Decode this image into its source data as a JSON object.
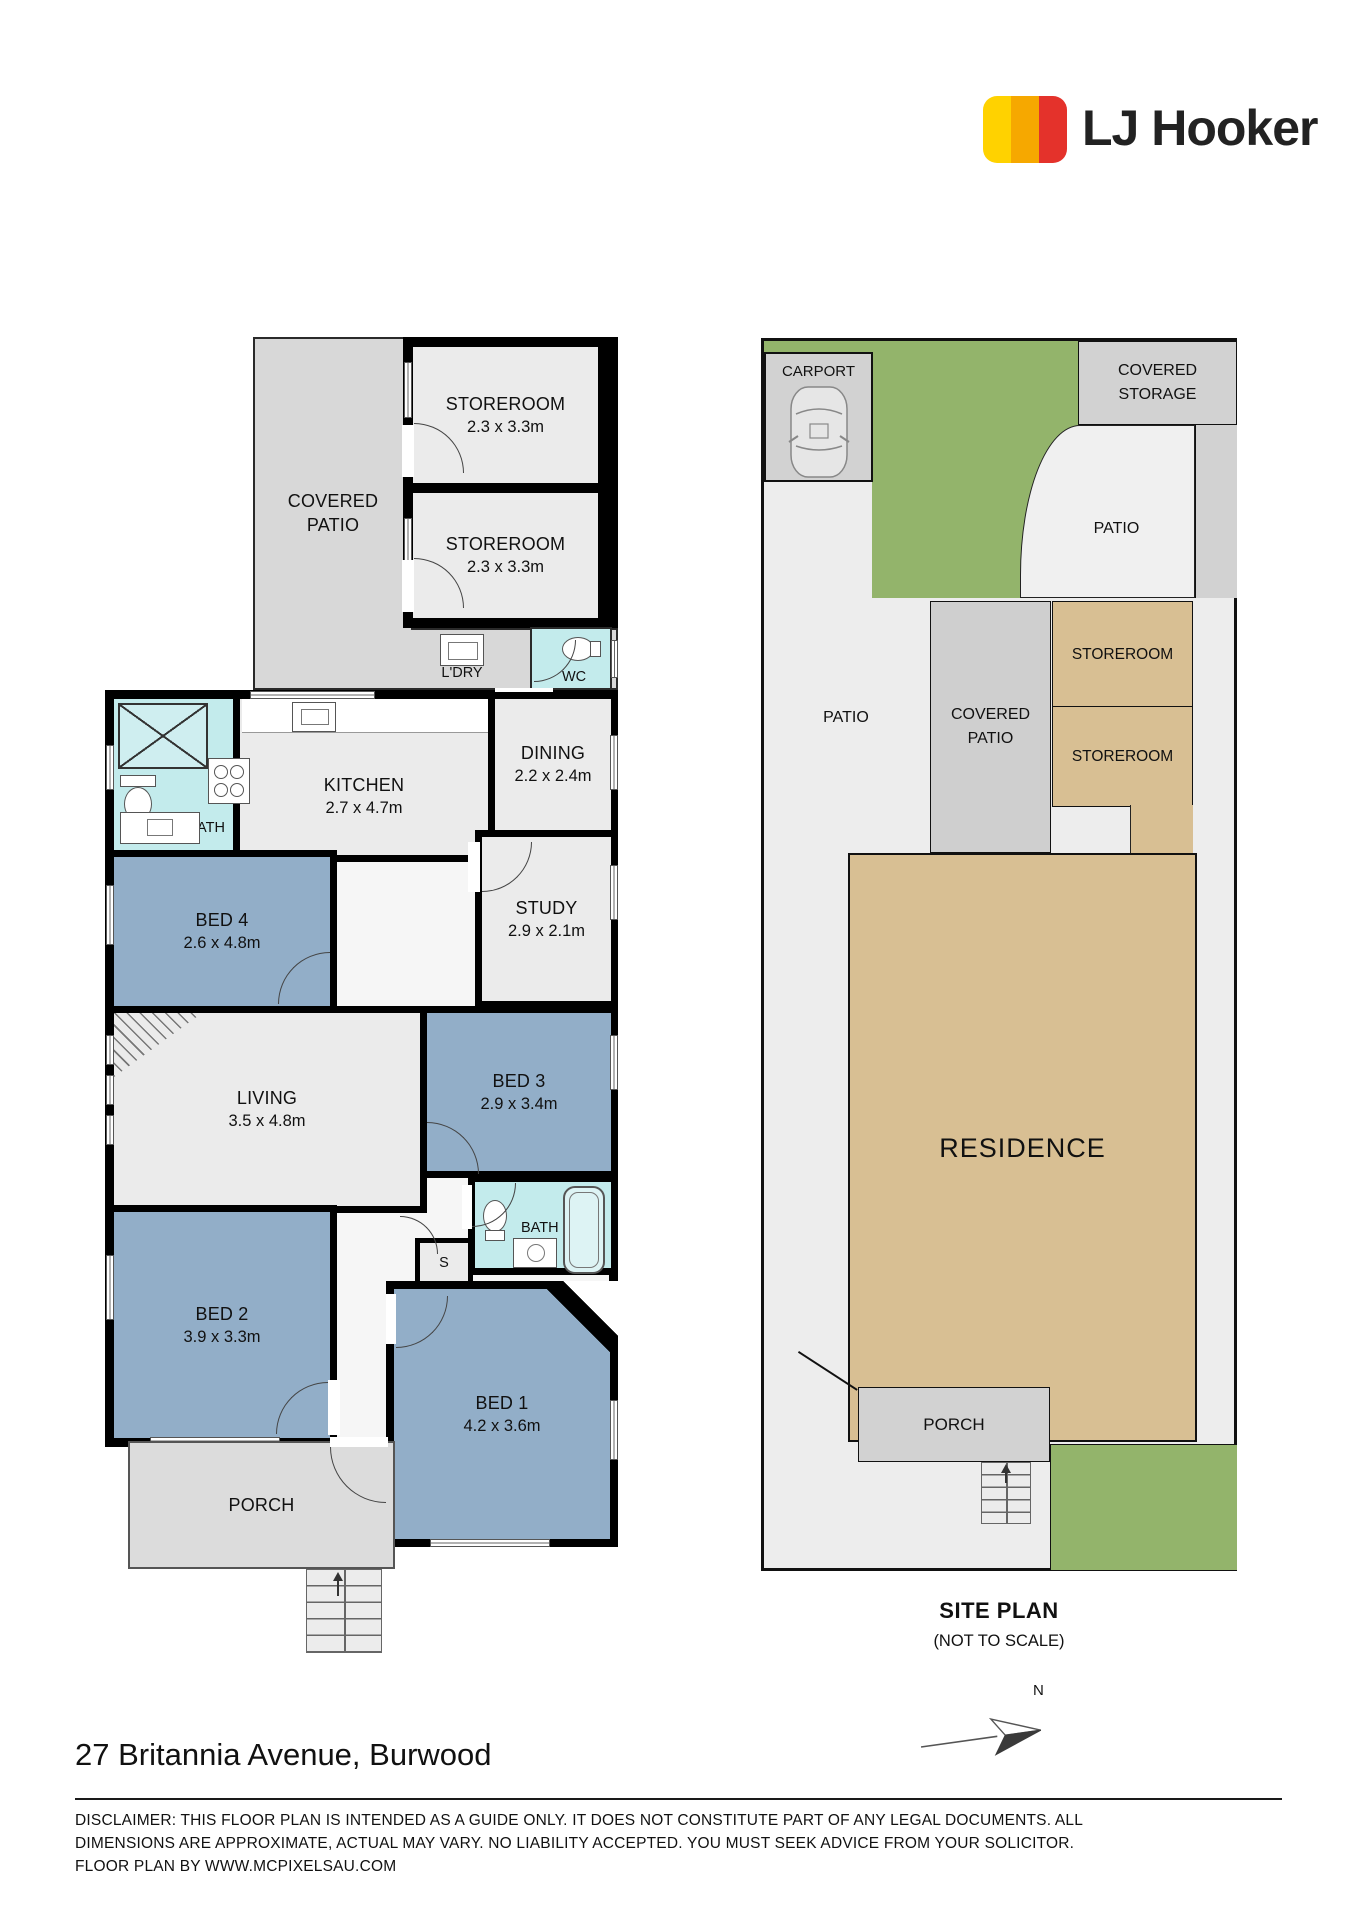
{
  "brand": {
    "name": "LJ Hooker"
  },
  "floor_plan": {
    "covered_patio": {
      "line1": "COVERED",
      "line2": "PATIO"
    },
    "storeroom_top1": {
      "name": "STOREROOM",
      "dims": "2.3 x 3.3m"
    },
    "storeroom_top2": {
      "name": "STOREROOM",
      "dims": "2.3 x 3.3m"
    },
    "laundry": {
      "name": "L'DRY"
    },
    "wc": {
      "name": "WC"
    },
    "kitchen": {
      "name": "KITCHEN",
      "dims": "2.7 x 4.7m"
    },
    "dining": {
      "name": "DINING",
      "dims": "2.2 x 2.4m"
    },
    "bath_top": {
      "name": "BATH"
    },
    "bed4": {
      "name": "BED 4",
      "dims": "2.6 x 4.8m"
    },
    "study": {
      "name": "STUDY",
      "dims": "2.9 x 2.1m"
    },
    "living": {
      "name": "LIVING",
      "dims": "3.5 x 4.8m"
    },
    "bed3": {
      "name": "BED 3",
      "dims": "2.9 x 3.4m"
    },
    "bath_bottom": {
      "name": "BATH"
    },
    "store_s": {
      "name": "S"
    },
    "bed2": {
      "name": "BED 2",
      "dims": "3.9 x 3.3m"
    },
    "bed1": {
      "name": "BED 1",
      "dims": "4.2 x 3.6m"
    },
    "porch": {
      "name": "PORCH"
    }
  },
  "site_plan": {
    "carport": "CARPORT",
    "covered_storage": {
      "line1": "COVERED",
      "line2": "STORAGE"
    },
    "patio_upper": "PATIO",
    "patio_left": "PATIO",
    "covered_patio": {
      "line1": "COVERED",
      "line2": "PATIO"
    },
    "storeroom1": "STOREROOM",
    "storeroom2": "STOREROOM",
    "residence": "RESIDENCE",
    "porch": "PORCH",
    "caption_title": "SITE PLAN",
    "caption_subtitle": "(NOT TO SCALE)"
  },
  "compass": {
    "north": "N"
  },
  "footer": {
    "address": "27 Britannia Avenue, Burwood",
    "disclaimer_line1": "DISCLAIMER: THIS FLOOR PLAN IS INTENDED AS A GUIDE ONLY.  IT DOES NOT CONSTITUTE PART OF ANY LEGAL DOCUMENTS.  ALL",
    "disclaimer_line2": "DIMENSIONS ARE APPROXIMATE, ACTUAL MAY VARY.  NO LIABILITY ACCEPTED. YOU MUST SEEK ADVICE FROM YOUR SOLICITOR.",
    "disclaimer_line3": "FLOOR PLAN BY WWW.MCPIXELSAU.COM"
  },
  "colors": {
    "wall": "#000000",
    "room_light": "#ebebeb",
    "bedroom_blue": "#92aec8",
    "wet_cyan": "#c3ebec",
    "patio_gray": "#d8d8d8",
    "porch_gray": "#dcdcdc",
    "site_green": "#93b46b",
    "site_tan": "#d8bf93",
    "site_gray": "#d2d2d2",
    "site_light": "#ededed",
    "logo_yellow": "#ffd200",
    "logo_orange": "#f6a800",
    "logo_red": "#e4322b"
  }
}
